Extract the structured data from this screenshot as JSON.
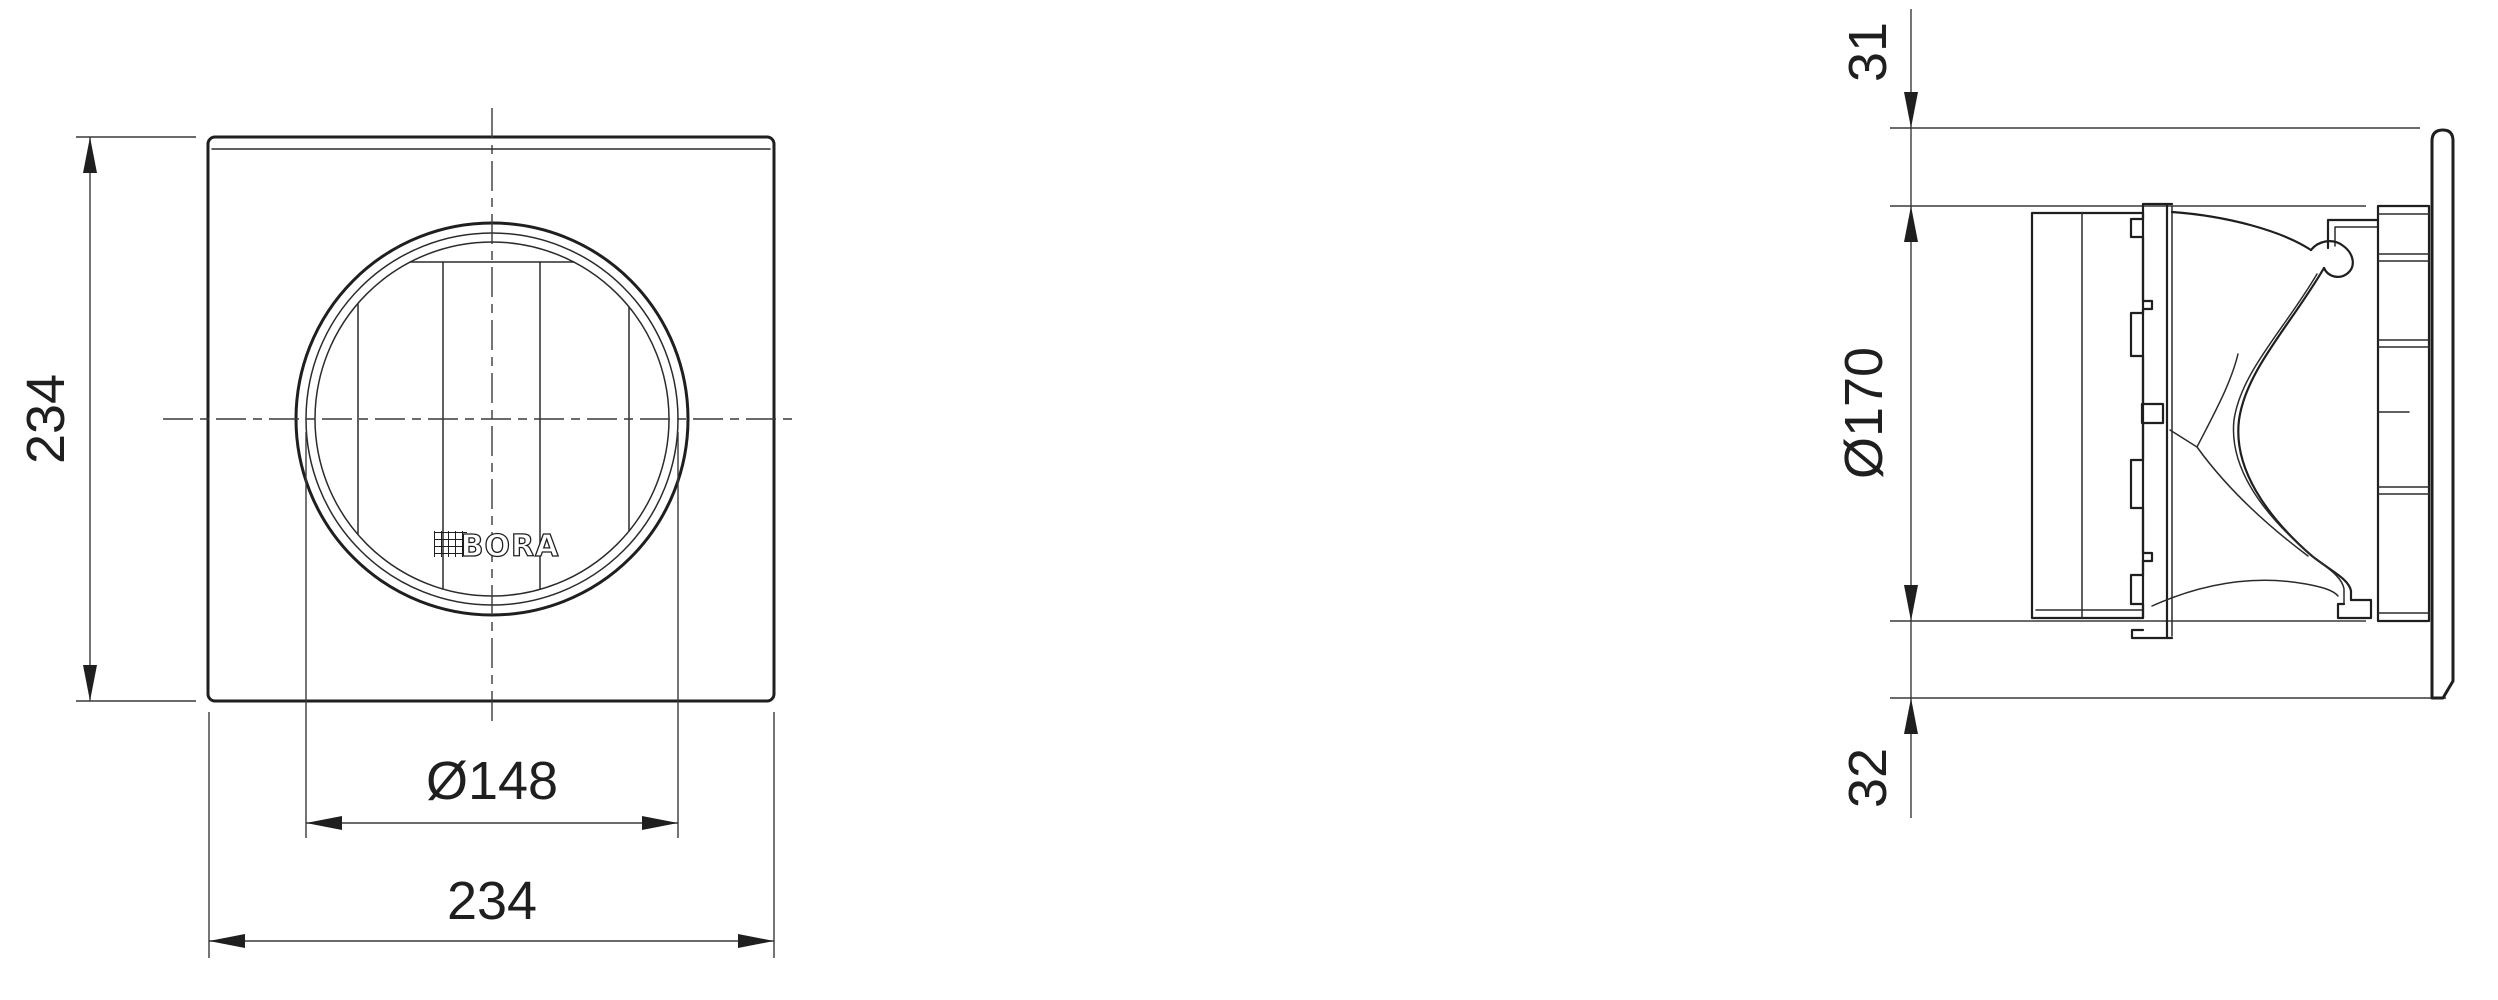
{
  "drawing": {
    "front_view": {
      "height_label": "234",
      "width_label": "234",
      "bore_label": "Ø148",
      "logo_text": "BORA"
    },
    "side_view": {
      "top_gap_label": "31",
      "outer_diameter_label": "Ø170",
      "bottom_gap_label": "32"
    },
    "colors": {
      "line": "#1f1f1f",
      "dimension": "#3a3a3a",
      "text": "#1f1f1f",
      "background": "#ffffff"
    }
  }
}
